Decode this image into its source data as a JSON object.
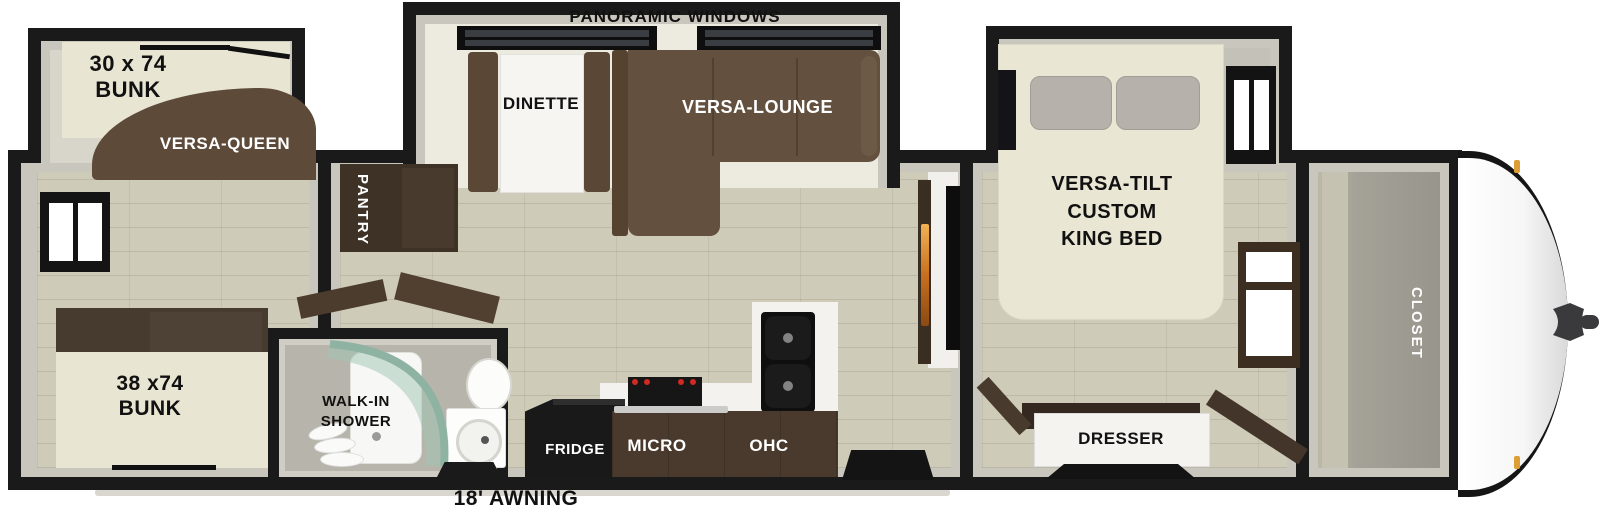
{
  "diagram": {
    "type": "rv-travel-trailer-floorplan",
    "labels": {
      "panoramic_windows": "PANORAMIC WINDOWS",
      "bunk_top": "30 x 74\nBUNK",
      "versa_queen": "VERSA-QUEEN",
      "dinette": "DINETTE",
      "versa_lounge": "VERSA-LOUNGE",
      "pantry": "PANTRY",
      "bunk_bottom": "38 x74\nBUNK",
      "walk_in_shower": "WALK-IN\nSHOWER",
      "fridge": "FRIDGE",
      "micro": "MICRO",
      "ohc": "OHC",
      "king_bed": "VERSA-TILT\nCUSTOM\nKING BED",
      "dresser": "DRESSER",
      "closet": "CLOSET",
      "awning": "18' AWNING"
    },
    "colors": {
      "wall_black": "#1a1a1a",
      "wall_liner_gray": "#c9c6bd",
      "floor_wood": "#cfcbb9",
      "sofa_brown": "#63503e",
      "cabinet_brown": "#43352a",
      "counter_brown": "#4a3a2d",
      "bed_cream": "#e9e5d3",
      "pillow_gray": "#b7b1ab",
      "shower_glass_teal": "#9fc0b0",
      "fireplace_amber": "#e8a33d",
      "marker_light_amber": "#dd9f35"
    }
  }
}
